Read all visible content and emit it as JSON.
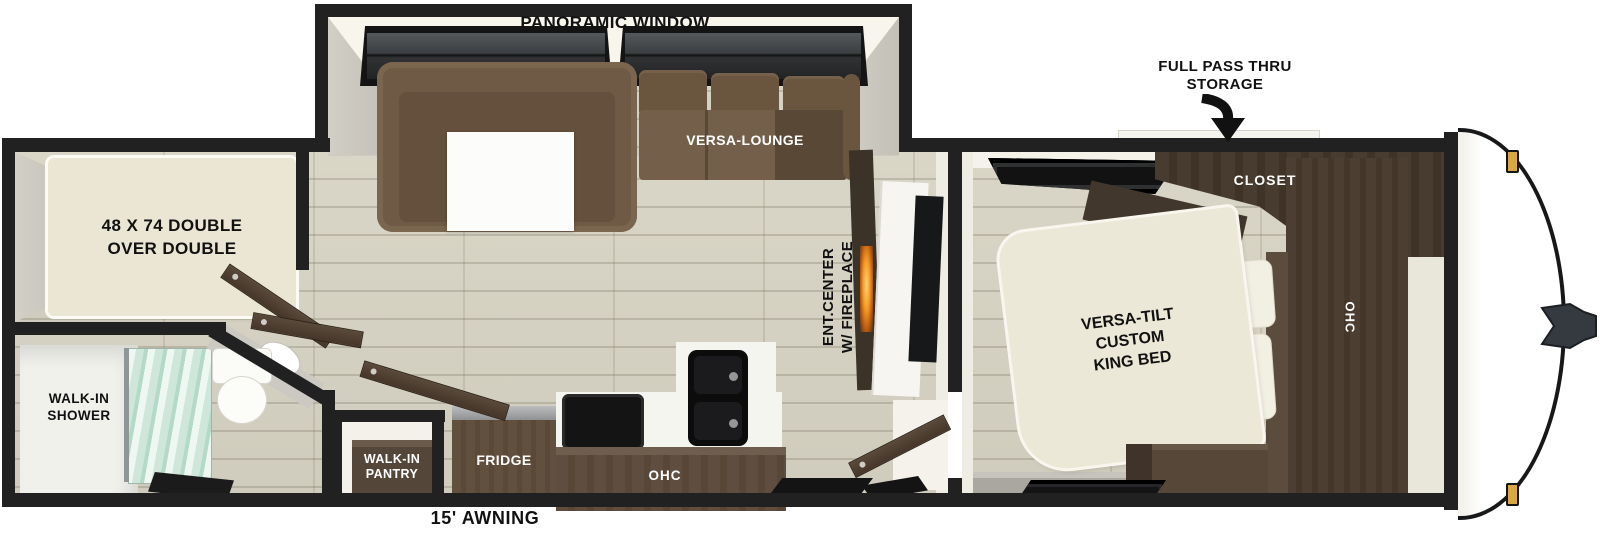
{
  "page": {
    "type": "travel-trailer-floorplan"
  },
  "labels": {
    "panoramic_window": "PANORAMIC WINDOW",
    "full_pass_thru": [
      "FULL PASS THRU",
      "STORAGE"
    ],
    "versa_lounge": "VERSA-LOUNGE",
    "bunk_bed": [
      "48 X 74 DOUBLE",
      "OVER DOUBLE"
    ],
    "closet": "CLOSET",
    "king_bed": [
      "VERSA-TILT",
      "CUSTOM",
      "KING BED"
    ],
    "bedroom_ohc": "OHC",
    "ent_center": [
      "ENT.CENTER",
      "W/ FIREPLACE"
    ],
    "walk_in_shower": [
      "WALK-IN",
      "SHOWER"
    ],
    "walk_in_pantry": [
      "WALK-IN",
      "PANTRY"
    ],
    "fridge": "FRIDGE",
    "kitchen_ohc": "OHC",
    "awning": "15' AWNING"
  },
  "colors": {
    "wall": "#212121",
    "floor_plank": "#d6d2c3",
    "sofa_brown": "#6f5a45",
    "cabinet_dark": "#483b2f",
    "cabinet_mid": "#5f4e40",
    "mattress_cream": "#ece8d7",
    "shower_glass": "#cfe7da",
    "fireplace_flame": "#f59a22",
    "marker_light_amber": "#d9a843"
  }
}
